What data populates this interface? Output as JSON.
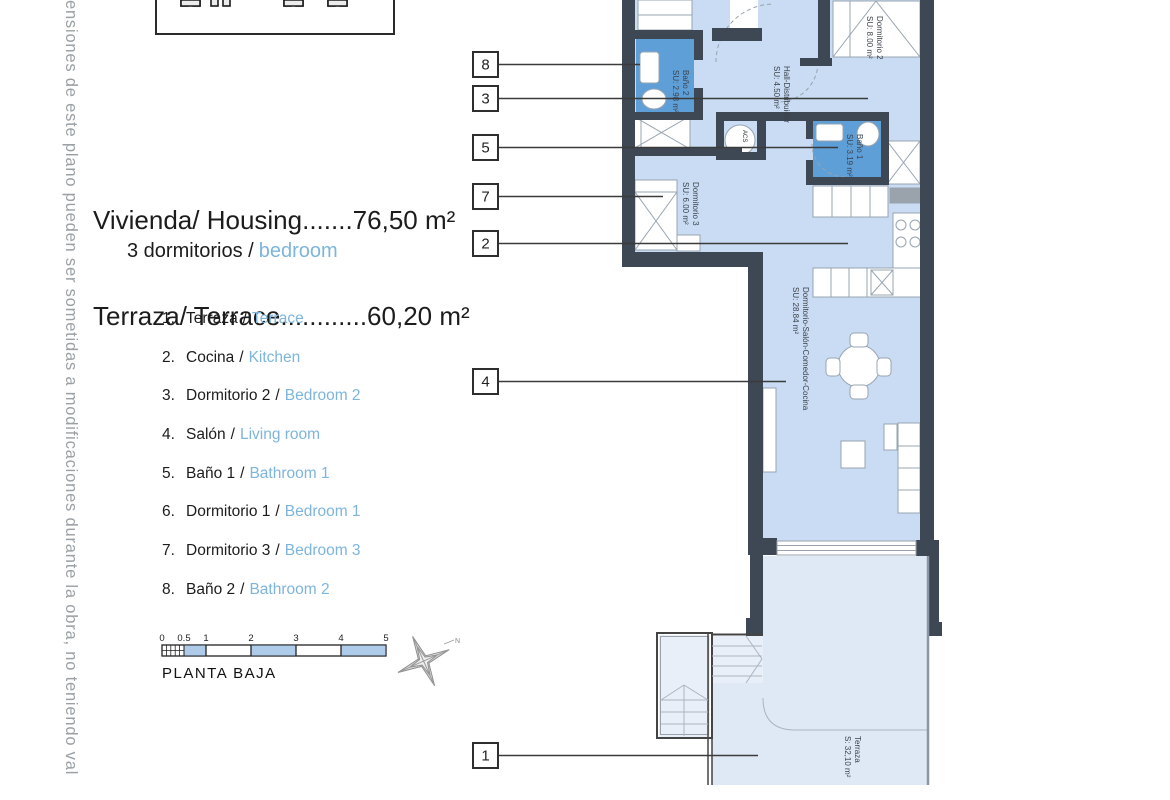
{
  "margin_note": {
    "text": "nensiones de este plano pueden ser sometidas a modificaciones durante la obra, no teniendo val"
  },
  "areas": {
    "line1": "Vivienda/ Housing.......76,50 m²",
    "line2": "Terraza/ Terrace............60,20 m²"
  },
  "bedrooms": {
    "es": "3 dormitorios /",
    "en": "bedroom"
  },
  "legend": {
    "sep": "/",
    "items": [
      {
        "num": "1.",
        "es": "Terraza",
        "en": "Terrace"
      },
      {
        "num": "2.",
        "es": "Cocina",
        "en": "Kitchen"
      },
      {
        "num": "3.",
        "es": "Dormitorio 2",
        "en": "Bedroom 2"
      },
      {
        "num": "4.",
        "es": "Salón",
        "en": "Living room"
      },
      {
        "num": "5.",
        "es": "Baño 1",
        "en": "Bathroom 1"
      },
      {
        "num": "6.",
        "es": "Dormitorio 1",
        "en": "Bedroom 1"
      },
      {
        "num": "7.",
        "es": "Dormitorio 3",
        "en": "Bedroom 3"
      },
      {
        "num": "8.",
        "es": "Baño 2",
        "en": "Bathroom 2"
      }
    ]
  },
  "scalebar": {
    "ticks": [
      "0",
      "0.5",
      "1",
      "2",
      "3",
      "4",
      "5"
    ],
    "caption": "PLANTA BAJA",
    "north_label": "N"
  },
  "plan": {
    "callouts": [
      "8",
      "3",
      "5",
      "7",
      "2",
      "4",
      "1"
    ],
    "rooms": {
      "dormitorio2": {
        "name": "Dormitorio 2",
        "area": "SU: 8.00 m²"
      },
      "hall": {
        "name": "Hall-Distribuidor",
        "area": "SU: 4.50 m²"
      },
      "bano1": {
        "name": "Baño 1",
        "area": "SU: 3.19 m²"
      },
      "bano2": {
        "name": "Baño 2",
        "area": "SU: 2.98 m²"
      },
      "dormitorio3": {
        "name": "Dormitorio 3",
        "area": "SU: 6.00 m²"
      },
      "salon": {
        "name": "Dormitorio-Salón-Comedor-Cocina",
        "area": "SU: 28.84 m²"
      },
      "terraza": {
        "name": "Terraza",
        "area": "S: 32,10 m²"
      },
      "acs": {
        "label": "ACS"
      }
    }
  },
  "colors": {
    "wall": "#3e4854",
    "room_fill": "#c9dcf3",
    "bathroom_fill": "#5f9fd8",
    "terrace_fill": "#dfe9f6",
    "accent_text": "#7db5dd",
    "scalebar_fill": "#aecce9"
  }
}
